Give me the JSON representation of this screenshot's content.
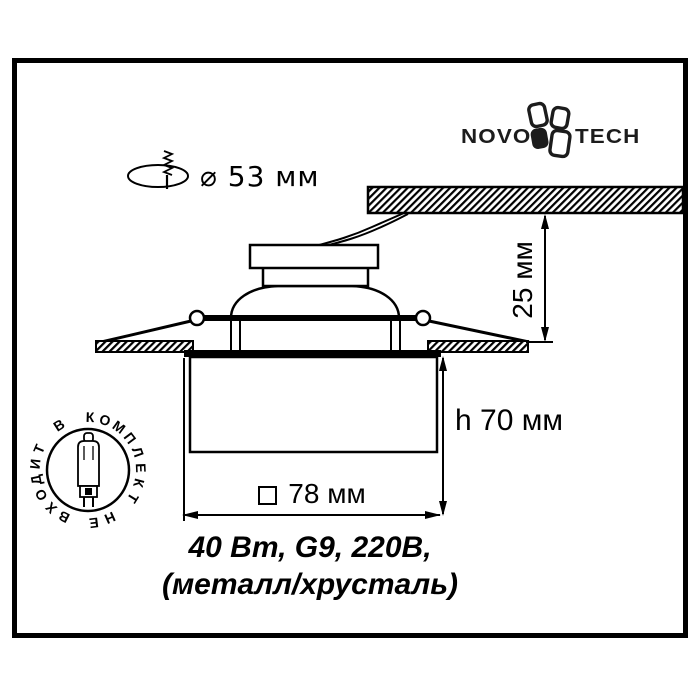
{
  "colors": {
    "line": "#000000",
    "background": "#ffffff",
    "logo": "#1c1c1c"
  },
  "logo": {
    "left": "NOVO",
    "right": "TECH"
  },
  "hole_dimension": {
    "label": "⌀ 53 мм"
  },
  "dimensions": {
    "depth_label": "25 мм",
    "height_label": "h 70 мм",
    "width_label": "78 мм",
    "width_symbol": "square-symbol"
  },
  "specs": {
    "line1": "40 Вт, G9, 220В,",
    "line2": "(металл/хрусталь)"
  },
  "stamp": {
    "ring_text": "НЕ ВХОДИТ В КОМПЛЕКТ ",
    "start_angle": 156,
    "center_x": 88,
    "center_y": 470,
    "radius": 53
  },
  "icons": [
    "mounting-hole-icon",
    "novotech-clover-icon",
    "g9-lamp-icon",
    "ceiling-hatch",
    "square-symbol"
  ]
}
